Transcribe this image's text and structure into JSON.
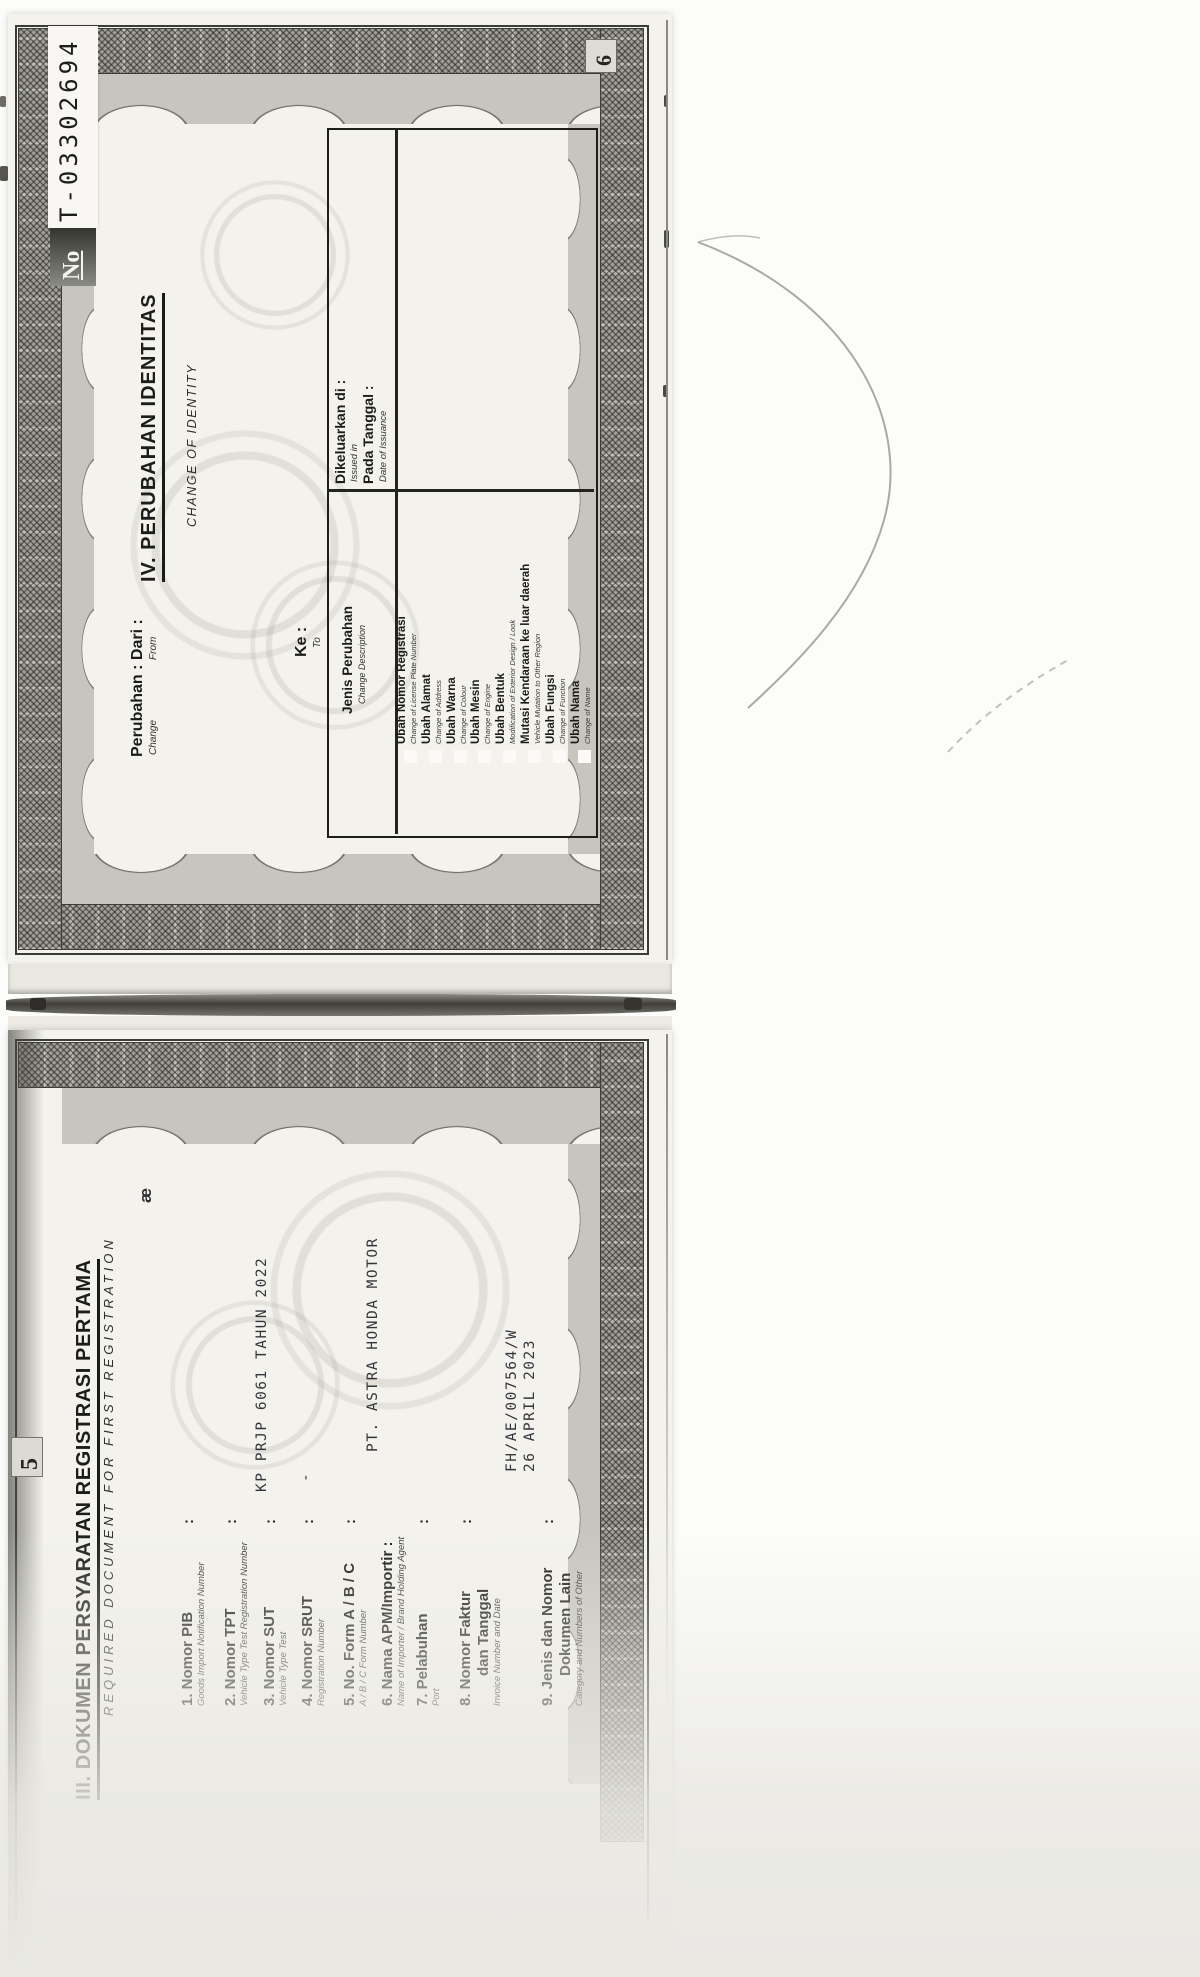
{
  "document": {
    "kind": "scanned vehicle ownership booklet (BPKB), rotated 90deg",
    "serial": {
      "label": "No",
      "number": "T-03302694"
    },
    "page6": {
      "page_number": "6",
      "title": "IV. PERUBAHAN IDENTITAS",
      "subtitle": "CHANGE OF IDENTITY",
      "field_perubahan": {
        "label": "Perubahan : Dari :",
        "en1": "Change",
        "en2": "From"
      },
      "field_ke": {
        "label": "Ke :",
        "en": "To"
      },
      "table": {
        "col_change": {
          "label": "Jenis Perubahan",
          "label_en": "Change Description"
        },
        "col_issued": {
          "label1": "Dikeluarkan di :",
          "label1_en": "Issued in",
          "label2": "Pada Tanggal :",
          "label2_en": "Date of Issuance"
        },
        "items": [
          {
            "label": "Ubah Nomor Registrasi",
            "label_en": "Change of License Plate Number",
            "checked": false
          },
          {
            "label": "Ubah Alamat",
            "label_en": "Change of Address",
            "checked": false
          },
          {
            "label": "Ubah Warna",
            "label_en": "Change of Colour",
            "checked": false
          },
          {
            "label": "Ubah Mesin",
            "label_en": "Change of Engine",
            "checked": false
          },
          {
            "label": "Ubah Bentuk",
            "label_en": "Modification of Exterior Design / Look",
            "checked": false
          },
          {
            "label": "Mutasi Kendaraan ke luar daerah",
            "label_en": "Vehicle Mutation to Other Region",
            "checked": false
          },
          {
            "label": "Ubah Fungsi",
            "label_en": "Change of Function",
            "checked": false
          },
          {
            "label": "Ubah Nama",
            "label_en": "Change of Name",
            "checked": false
          }
        ]
      }
    },
    "page5": {
      "page_number": "5",
      "title": "III. DOKUMEN PERSYARATAN REGISTRASI PERTAMA",
      "subtitle": "REQUIRED DOCUMENT FOR FIRST REGISTRATION",
      "handwritten_mark": "æ",
      "colon": ":",
      "items": [
        {
          "no": "1.",
          "label": "1. Nomor PIB",
          "label_en": "Goods Import Notification Number",
          "value": ""
        },
        {
          "no": "2.",
          "label": "2. Nomor TPT",
          "label_en": "Vehicle Type Test Registration Number",
          "value": ""
        },
        {
          "no": "3.",
          "label": "3. Nomor SUT",
          "label_en": "Vehicle Type Test",
          "value": "KP PRJP 6061 TAHUN 2022"
        },
        {
          "no": "4.",
          "label": "4. Nomor SRUT",
          "label_en": "Registration Number",
          "value": "-"
        },
        {
          "no": "5.",
          "label": "5. No. Form A / B / C",
          "label_en": "A / B / C Form Number",
          "value": ""
        },
        {
          "no": "6.",
          "label": "6. Nama APM/Importir :",
          "label_en": "Name of Importer / Brand Holding Agent",
          "value": "PT. ASTRA HONDA MOTOR"
        },
        {
          "no": "7.",
          "label": "7. Pelabuhan",
          "label_en": "Port",
          "value": ""
        },
        {
          "no": "8.",
          "label": "8. Nomor Faktur",
          "label2": "dan Tanggal",
          "label_en": "Invoice Number and Date",
          "value": "FH/AE/007564/W",
          "value2": "26 APRIL 2023"
        },
        {
          "no": "9.",
          "label": "9. Jenis dan Nomor",
          "label2": "Dokumen Lain",
          "label_en": "Category and Numbers of Other",
          "value": ""
        }
      ]
    }
  },
  "colors": {
    "paper": "#f3f2ec",
    "ink": "#1c1c1c",
    "typed_ink": "#34343c",
    "band_gray": "#a19f98"
  }
}
